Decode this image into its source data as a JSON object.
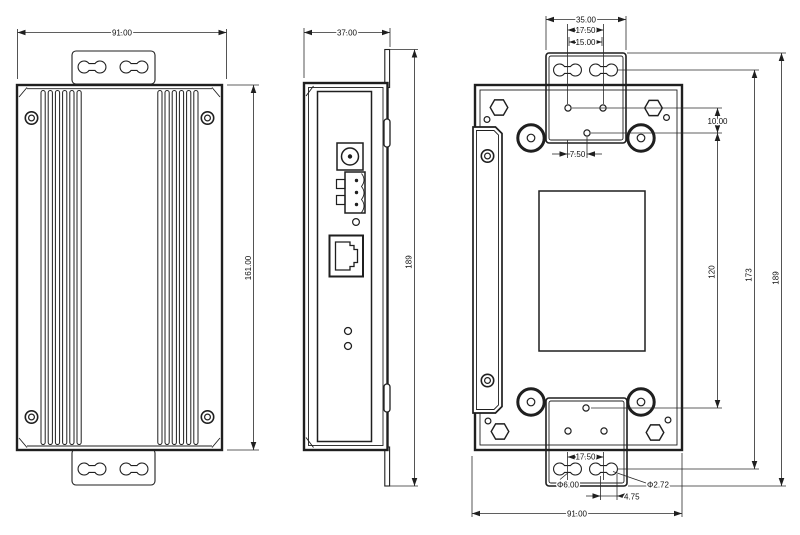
{
  "drawing": {
    "background": "#ffffff",
    "line_color": "#1f1f1f",
    "views": {
      "front": {
        "dims": {
          "width": "91.00",
          "height": "161.00"
        }
      },
      "side": {
        "dims": {
          "depth": "37.00",
          "overall_height": "189"
        }
      },
      "back": {
        "dims": {
          "bracket_width": "35.00",
          "top_slot_spacing": "17.50",
          "top_hole_spacing": "15.00",
          "hole_offset_v": "10.00",
          "hole_offset_h": "7.50",
          "center_hole_span": "120",
          "slot_span": "173",
          "overall_height": "189",
          "bottom_slot_spacing": "17.50",
          "slot_diameter": "Φ6.00",
          "hole_diameter": "Φ2.72",
          "slot_edge_offset": "4.75",
          "overall_width": "91.00"
        }
      }
    }
  }
}
